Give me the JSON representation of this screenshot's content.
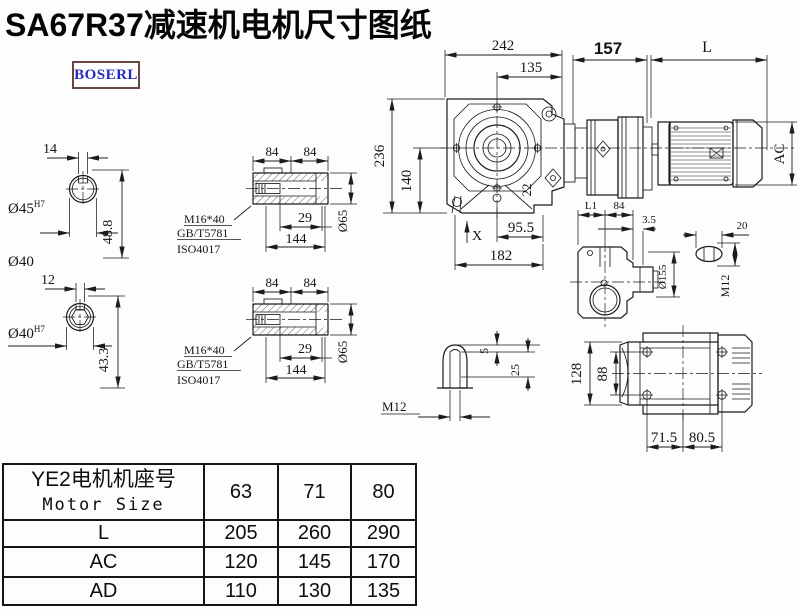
{
  "title": "SA67R37减速机电机尺寸图纸",
  "brand": "BOSERL",
  "colors": {
    "line": "#1c1c1c",
    "brand_text": "#2329c0",
    "brand_border": "#6b4540",
    "background": "#fdfdfd"
  },
  "drawing": {
    "shaft45": {
      "key_w": "14",
      "bore": "Ø45",
      "tol": "H7",
      "height": "48.8",
      "outer": "Ø40"
    },
    "shaft40": {
      "key_w": "12",
      "bore": "Ø40",
      "tol": "H7",
      "height": "43.3"
    },
    "hollow": {
      "seg1": "84",
      "seg2": "84",
      "screw": "M16*40",
      "std1": "GB/T5781",
      "std2": "ISO4017",
      "depth": "29",
      "length": "144",
      "dia": "Ø65"
    },
    "main": {
      "w242": "242",
      "w135": "135",
      "w157": "157",
      "wL": "L",
      "h236": "236",
      "h140": "140",
      "lug22": "22",
      "footX": "X",
      "w955": "95.5",
      "w182": "182",
      "ac": "AC"
    },
    "side": {
      "l1": "L1",
      "w84": "84",
      "t35": "3.5",
      "dia155": "Ø155",
      "w20": "20",
      "m12": "M12"
    },
    "plug": {
      "d5": "5",
      "d25": "25",
      "m12": "M12"
    },
    "bottom": {
      "h128": "128",
      "h88": "88",
      "w715": "71.5",
      "w805": "80.5"
    }
  },
  "table": {
    "header_cn": "YE2电机机座号",
    "header_en": "Motor Size",
    "columns": [
      "63",
      "71",
      "80"
    ],
    "rows": [
      {
        "label": "L",
        "values": [
          "205",
          "260",
          "290"
        ]
      },
      {
        "label": "AC",
        "values": [
          "120",
          "145",
          "170"
        ]
      },
      {
        "label": "AD",
        "values": [
          "110",
          "130",
          "135"
        ]
      }
    ]
  }
}
